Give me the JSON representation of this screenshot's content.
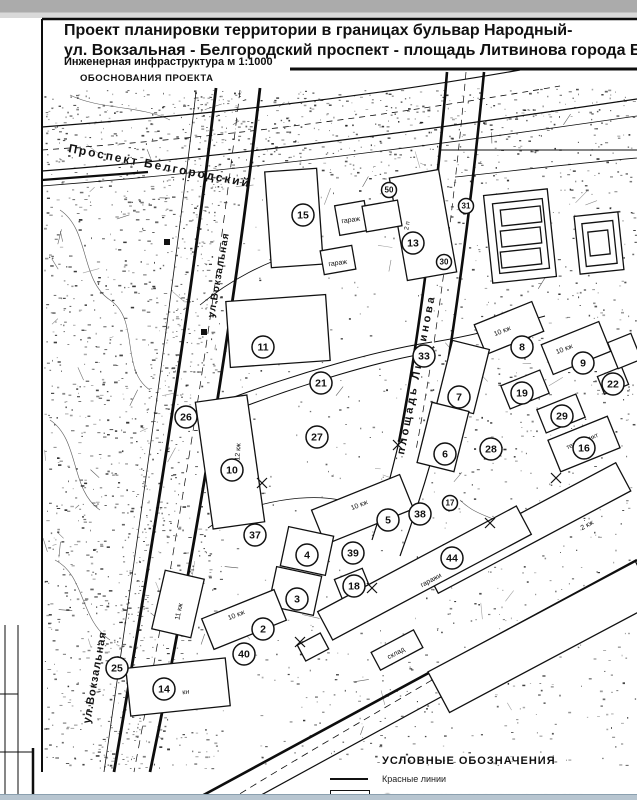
{
  "colors": {
    "ink": "#111111",
    "page": "#ffffff",
    "chrome_top": "#ababab",
    "chrome_bottom": "#b7c5d0"
  },
  "title_block": {
    "line1": "Проект планировки территории в границах бульвар Народный-",
    "line2": "ул. Вокзальная - Белгородский проспект - площадь Литвинова города Белгорода",
    "scale_note": "Инженерная инфраструктура м 1:1000",
    "stage": "ОБОСНОВАНИЯ ПРОЕКТА"
  },
  "map": {
    "street_labels": [
      {
        "text": "Проспект Белгородский",
        "x": 68,
        "y": 152,
        "rot": 11,
        "size": 12,
        "spacing": 2
      },
      {
        "text": "ул.Вокзальная",
        "x": 214,
        "y": 318,
        "rot": -80,
        "size": 10,
        "spacing": 1
      },
      {
        "text": "площадь Литвинова",
        "x": 404,
        "y": 455,
        "rot": -79,
        "size": 11,
        "spacing": 3
      },
      {
        "text": "ул.Вокзальная",
        "x": 90,
        "y": 724,
        "rot": -80,
        "size": 11,
        "spacing": 1
      }
    ],
    "markers": [
      {
        "n": "15",
        "x": 303,
        "y": 215
      },
      {
        "n": "13",
        "x": 413,
        "y": 243
      },
      {
        "n": "11",
        "x": 263,
        "y": 347
      },
      {
        "n": "21",
        "x": 321,
        "y": 383
      },
      {
        "n": "26",
        "x": 186,
        "y": 417
      },
      {
        "n": "27",
        "x": 317,
        "y": 437
      },
      {
        "n": "10",
        "x": 232,
        "y": 470
      },
      {
        "n": "33",
        "x": 424,
        "y": 356
      },
      {
        "n": "7",
        "x": 459,
        "y": 397
      },
      {
        "n": "8",
        "x": 522,
        "y": 347
      },
      {
        "n": "9",
        "x": 583,
        "y": 363
      },
      {
        "n": "19",
        "x": 522,
        "y": 393
      },
      {
        "n": "22",
        "x": 613,
        "y": 384
      },
      {
        "n": "29",
        "x": 562,
        "y": 416
      },
      {
        "n": "16",
        "x": 584,
        "y": 448
      },
      {
        "n": "6",
        "x": 445,
        "y": 454
      },
      {
        "n": "28",
        "x": 491,
        "y": 449
      },
      {
        "n": "5",
        "x": 388,
        "y": 520
      },
      {
        "n": "38",
        "x": 420,
        "y": 514
      },
      {
        "n": "37",
        "x": 255,
        "y": 535
      },
      {
        "n": "4",
        "x": 307,
        "y": 555
      },
      {
        "n": "39",
        "x": 353,
        "y": 553
      },
      {
        "n": "18",
        "x": 354,
        "y": 586
      },
      {
        "n": "3",
        "x": 297,
        "y": 599
      },
      {
        "n": "2",
        "x": 263,
        "y": 629
      },
      {
        "n": "40",
        "x": 244,
        "y": 654
      },
      {
        "n": "44",
        "x": 452,
        "y": 558
      },
      {
        "n": "25",
        "x": 117,
        "y": 668
      },
      {
        "n": "14",
        "x": 164,
        "y": 689
      },
      {
        "n": "50",
        "x": 389,
        "y": 190,
        "small": true
      },
      {
        "n": "31",
        "x": 466,
        "y": 206,
        "small": true
      },
      {
        "n": "30",
        "x": 444,
        "y": 262,
        "small": true
      },
      {
        "n": "17",
        "x": 450,
        "y": 503,
        "small": true
      }
    ],
    "building_labels": [
      {
        "text": "гараж",
        "x": 351,
        "y": 222,
        "rot": -8,
        "size": 7
      },
      {
        "text": "гараж",
        "x": 338,
        "y": 265,
        "rot": -8,
        "size": 7
      },
      {
        "text": "2 п",
        "x": 409,
        "y": 226,
        "rot": -80,
        "size": 6.5
      },
      {
        "text": "12 кж",
        "x": 240,
        "y": 452,
        "rot": -86,
        "size": 7
      },
      {
        "text": "10 кж",
        "x": 503,
        "y": 333,
        "rot": -22,
        "size": 7
      },
      {
        "text": "10 кж",
        "x": 565,
        "y": 351,
        "rot": -22,
        "size": 7
      },
      {
        "text": "10 кж",
        "x": 360,
        "y": 507,
        "rot": -22,
        "size": 7
      },
      {
        "text": "10 кж",
        "x": 237,
        "y": 617,
        "rot": -22,
        "size": 7
      },
      {
        "text": "11 кж",
        "x": 181,
        "y": 612,
        "rot": -78,
        "size": 7
      },
      {
        "text": "2 кж",
        "x": 588,
        "y": 527,
        "rot": -28,
        "size": 7
      },
      {
        "text": "теплопункт",
        "x": 583,
        "y": 443,
        "rot": -22,
        "size": 6.5
      },
      {
        "text": "гаражи",
        "x": 432,
        "y": 582,
        "rot": -28,
        "size": 7
      },
      {
        "text": "склад",
        "x": 397,
        "y": 655,
        "rot": -28,
        "size": 7
      },
      {
        "text": "кн",
        "x": 186,
        "y": 694,
        "rot": -6,
        "size": 7
      }
    ]
  },
  "legend": {
    "title": "УСЛОВНЫЕ  ОБОЗНАЧЕНИЯ",
    "items": [
      {
        "symbol": "line",
        "label": "Красные линии"
      },
      {
        "symbol": "rect",
        "label": "Сохраняющиеся многоквартирные жилые дома",
        "blurred": true
      }
    ]
  }
}
